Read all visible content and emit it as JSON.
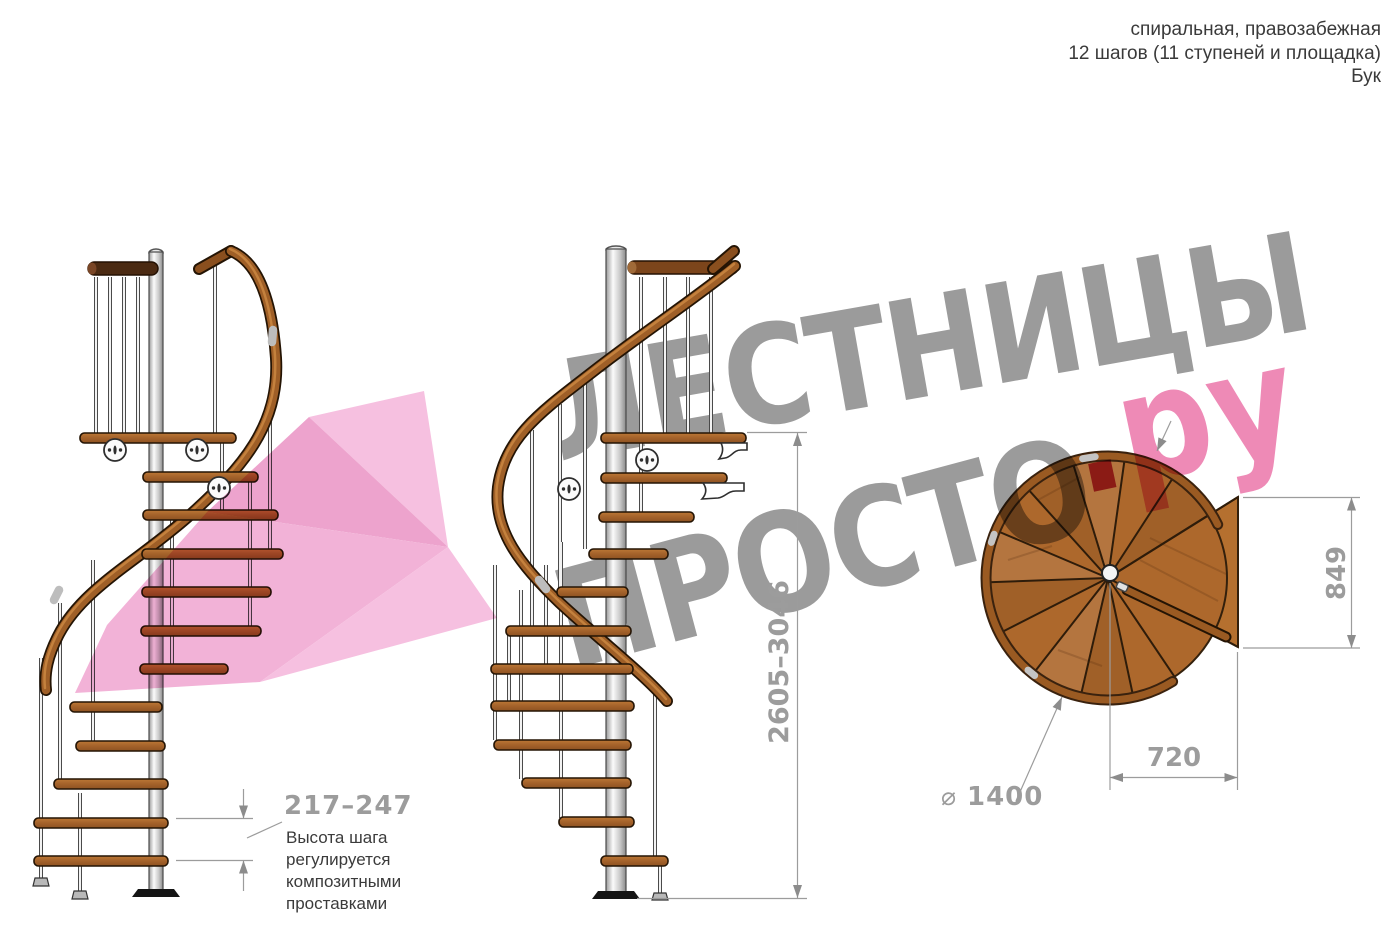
{
  "header": {
    "line1": "спиральная, правозабежная",
    "line2": "12 шагов (11 ступеней и площадка)",
    "line3": "Бук"
  },
  "watermark": {
    "word1": "ЛЕСТНИЦЫ",
    "word2": "ПРОСТО",
    "dot": ".",
    "suffix": "ру",
    "gray": "#9b9b9b",
    "pink": "#ee8ab6",
    "red": "#c53a55"
  },
  "dimensions": {
    "step_height": "217–247",
    "step_note_lines": [
      "Высота шага",
      "регулируется",
      "композитными",
      "проставками"
    ],
    "total_height": "2605–3046",
    "plan_height": "849",
    "plan_width": "720",
    "diameter_symbol": "⌀",
    "diameter_value": "1400"
  },
  "colors": {
    "dim_gray": "#9c9c9c",
    "note_dark": "#3b3b3b",
    "wood": "#ad682c",
    "rail_brown": "#9f5f27",
    "dark_outline": "#241404",
    "pink_arrow": "#f2b2d7"
  }
}
